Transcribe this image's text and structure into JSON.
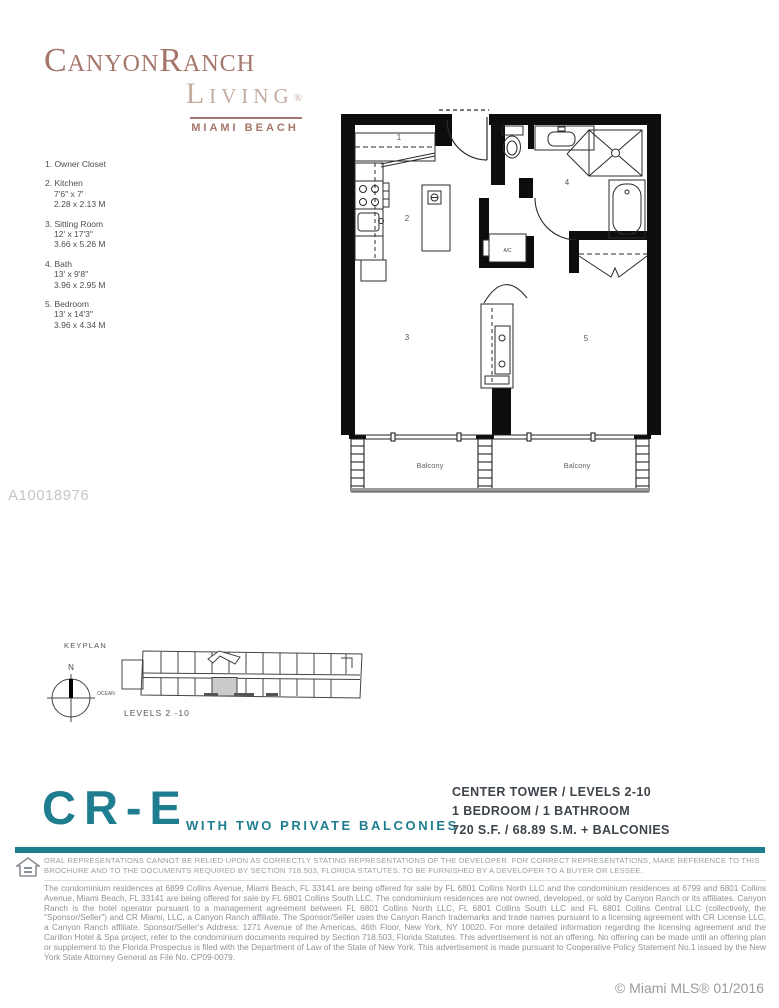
{
  "logo": {
    "name1": "CanyonRanch",
    "name2": "Living",
    "registered": "®",
    "city": "MIAMI BEACH",
    "color_primary": "#a5766b",
    "color_secondary": "#c4aca1"
  },
  "legend": {
    "items": [
      {
        "label": "1. Owner Closet",
        "dim1": "",
        "dim2": ""
      },
      {
        "label": "2. Kitchen",
        "dim1": "7'6\" x 7'",
        "dim2": "2.28 x 2.13 M"
      },
      {
        "label": "3. Sitting Room",
        "dim1": "12' x 17'3\"",
        "dim2": "3.66 x 5.26 M"
      },
      {
        "label": "4. Bath",
        "dim1": "13' x 9'8\"",
        "dim2": "3.96 x 2.95 M"
      },
      {
        "label": "5. Bedroom",
        "dim1": "13' x 14'3\"",
        "dim2": "3.96 x 4.34 M"
      }
    ]
  },
  "watermark": "A10018976",
  "floorplan": {
    "rooms": {
      "r1": "1",
      "r2": "2",
      "r3": "3",
      "r4": "4",
      "r5": "5"
    },
    "balcony_left": "Balcony",
    "balcony_right": "Balcony",
    "ac_label": "A/C"
  },
  "keyplan": {
    "title": "KEYPLAN",
    "north": "N",
    "ocean": "OCEAN",
    "levels": "LEVELS 2 -10"
  },
  "unit": {
    "code": "CR-E",
    "tagline": "WITH TWO PRIVATE BALCONIES",
    "tower": "CENTER TOWER / LEVELS 2-10",
    "bed_bath": "1 BEDROOM / 1 BATHROOM",
    "area": "720 S.F. /  68.89  S.M. + BALCONIES",
    "accent_color": "#1e7d8e"
  },
  "disclaimer": {
    "oral": "ORAL REPRESENTATIONS CANNOT BE RELIED UPON AS CORRECTLY STATING REPRESENTATIONS OF THE DEVELOPER. FOR CORRECT REPRESENTATIONS, MAKE REFERENCE TO THIS BROCHURE AND TO THE DOCUMENTS REQUIRED BY SECTION 718.503, FLORIDA STATUTES, TO BE FURNISHED BY A DEVELOPER TO A BUYER OR LESSEE.",
    "body": "The condominium residences at 6899 Collins Avenue, Miami Beach, FL 33141 are being offered for sale by FL 6801 Collins North LLC and the condominium residences at 6799 and 6801 Collins Avenue, Miami Beach, FL 33141 are being offered for sale by FL 6801 Collins South LLC. The condominium residences are not owned, developed, or sold by Canyon Ranch or its affiliates. Canyon Ranch is the hotel operator pursuant to a management agreement between FL 6801 Collins North LLC, FL 6801 Collins South LLC and FL 6801 Collins Central LLC (collectively, the \"Sponsor/Seller\") and CR Miami, LLC, a Canyon Ranch affiliate. The Sponsor/Seller uses the Canyon Ranch trademarks and trade names pursuant to a licensing agreement with CR License LLC, a Canyon Ranch affiliate. Sponsor/Seller's Address: 1271 Avenue of the Americas, 46th Floor, New York, NY 10020. For more detailed information regarding the licensing agreement and the Carillon Hotel & Spa project, refer to the condominium documents required by Section 718.503, Florida Statutes. This advertisement is not an offering. No offering can be made until an offering plan or supplement to the Florida Prospectus is filed with the Department of Law of the State of New York. This advertisement is made pursuant to Cooperative Policy Statement No.1 issued by the New York State Attorney General as File No. CP09-0079."
  },
  "footer": {
    "mls": "© Miami MLS® 01/2016"
  }
}
